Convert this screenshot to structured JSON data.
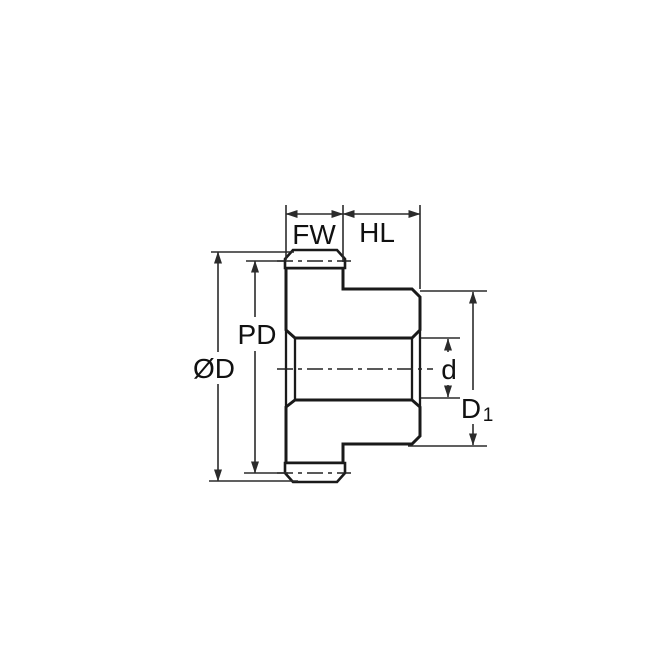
{
  "diagram": {
    "background": "#ffffff",
    "part_fill": "#c5e6f8",
    "outline_color": "#1a1a1a",
    "dimension_color": "#2b2b2b",
    "labels": {
      "face_width": "FW",
      "hub_length": "HL",
      "pitch_diameter": "PD",
      "outside_diameter": "ØD",
      "bore_diameter": "d",
      "hub_diameter_base": "D",
      "hub_diameter_subscript": "1"
    }
  }
}
